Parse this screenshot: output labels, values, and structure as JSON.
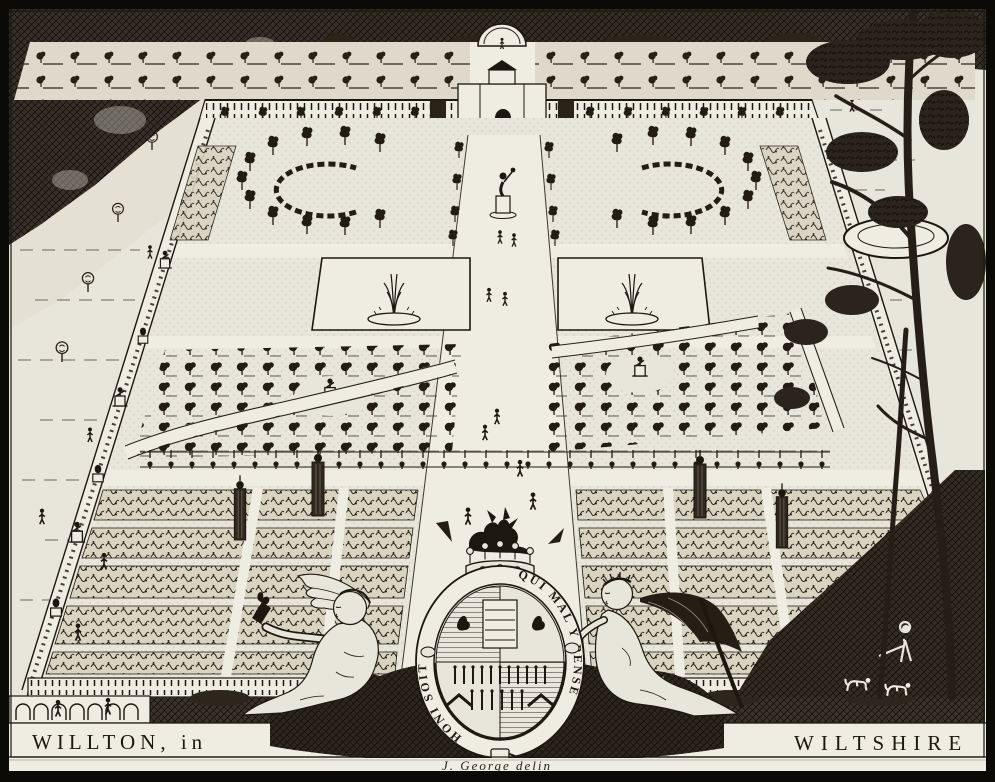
{
  "artwork": {
    "caption_left": "WILLTON, in",
    "caption_right": "WILTSHIRE",
    "signature": "J. George delin",
    "garter": {
      "motto_left": "HONI SOIT",
      "motto_right": "QUI MAL Y PENSE"
    }
  },
  "colors": {
    "paper": "#e8e5da",
    "paperlight": "#efece2",
    "ink": "#1c170f",
    "foliage": "#332d23",
    "bedtone": "#d9d3c2"
  }
}
